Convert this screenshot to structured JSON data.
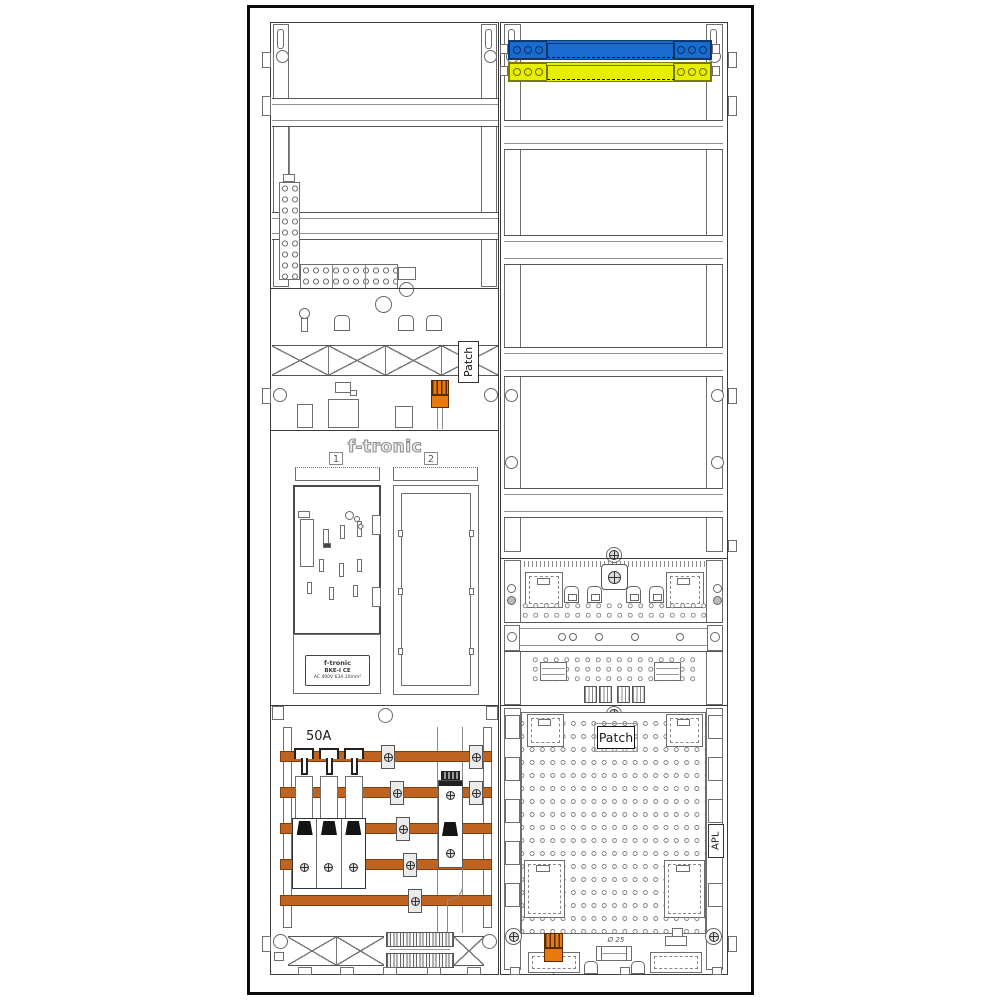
{
  "left_column": {
    "patch_label": "Patch",
    "meter_panel": {
      "brand": "f-tronic",
      "slot1": "1",
      "slot2": "2",
      "bke_label": {
        "line1": "f-tronic",
        "line2": "BKE-I  CE",
        "line3": "AC 400V   63A   10mm²"
      }
    },
    "breaker_section": {
      "rating": "50A"
    }
  },
  "right_column": {
    "apl_section": {
      "patch_label": "Patch",
      "apl_label": "APL",
      "conduit_note": "Ø 25"
    }
  },
  "colors": {
    "neutral_busbar": "#1a6bd0",
    "pe_busbar": "#e8ee00",
    "connector_orange": "#e8790f",
    "copper_busbar": "#bf6320"
  }
}
